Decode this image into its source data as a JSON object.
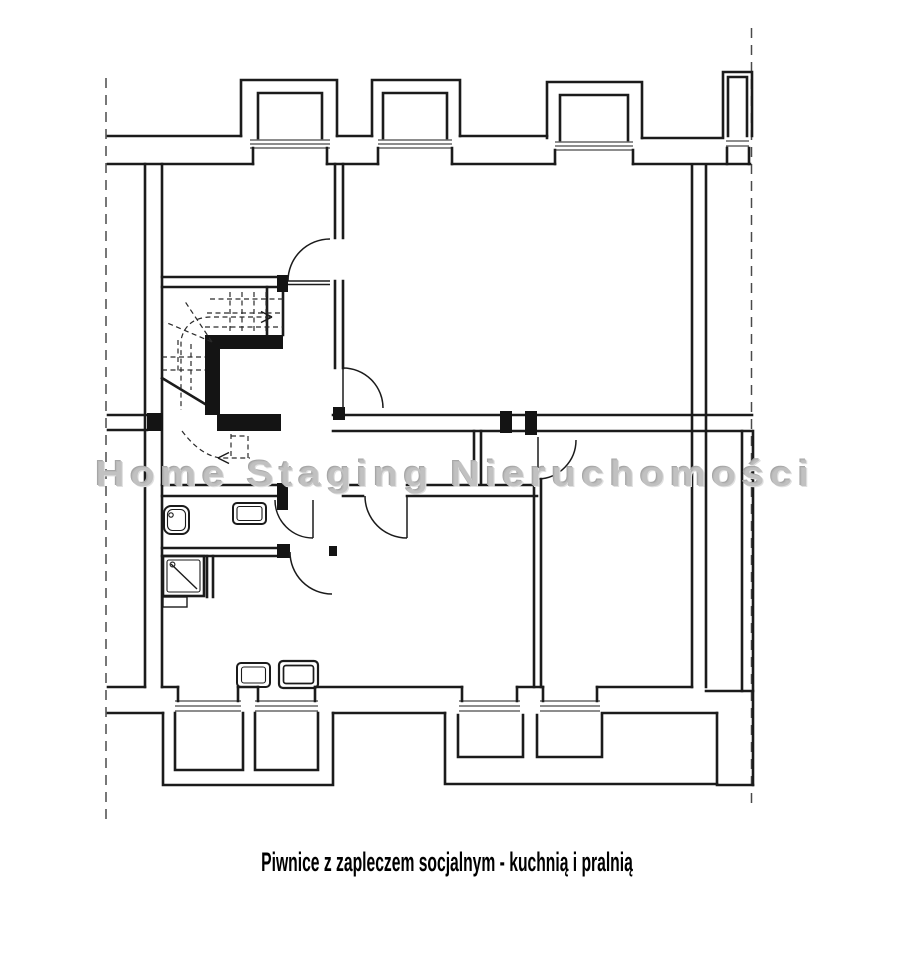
{
  "page": {
    "width": 905,
    "height": 960,
    "background": "#ffffff",
    "ink_color": "#1b1b1b",
    "watermark_color": "#bcbcbc"
  },
  "watermark": {
    "text": "Home Staging Nieruchomości"
  },
  "caption": {
    "text": "Piwnice z zapleczem socjalnym - kuchnią i pralnią"
  }
}
